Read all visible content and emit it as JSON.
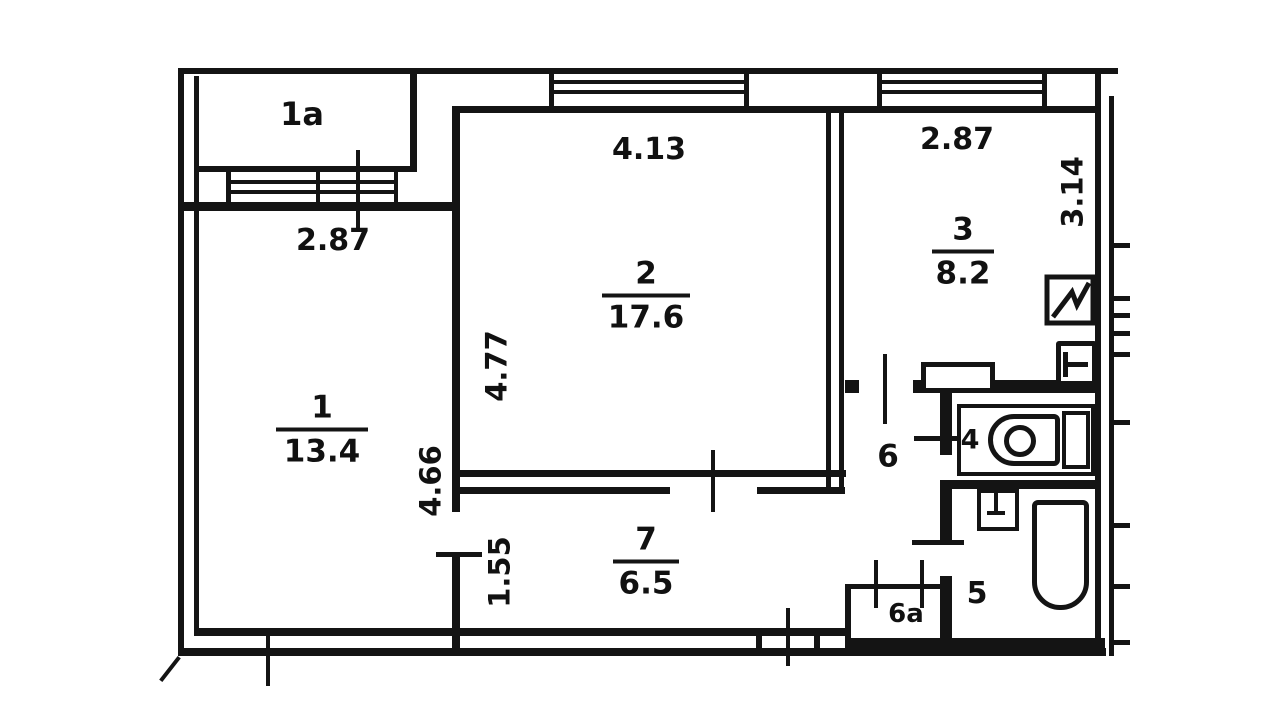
{
  "rooms": {
    "r1a": {
      "label": "1a"
    },
    "r1": {
      "label": "1",
      "area": "13.4"
    },
    "r2": {
      "label": "2",
      "area": "17.6"
    },
    "r3": {
      "label": "3",
      "area": "8.2"
    },
    "r4": {
      "label": "4"
    },
    "r5": {
      "label": "5"
    },
    "r6": {
      "label": "6"
    },
    "r6a": {
      "label": "6a"
    },
    "r7": {
      "label": "7",
      "area": "6.5"
    }
  },
  "dimensions": {
    "room1_window_width": "2.87",
    "room1_depth": "4.66",
    "room2_width": "4.13",
    "room2_depth": "4.77",
    "room3_width": "2.87",
    "room3_depth": "3.14",
    "room7_width": "1.55"
  },
  "icons": {
    "toilet": "toilet-icon",
    "bathtub": "bathtub-icon",
    "washbasin": "washbasin-icon",
    "kitchen_sink": "kitchen-sink-icon",
    "stove": "stove-icon"
  },
  "colors": {
    "ink": "#141414",
    "paper": "#ffffff"
  }
}
